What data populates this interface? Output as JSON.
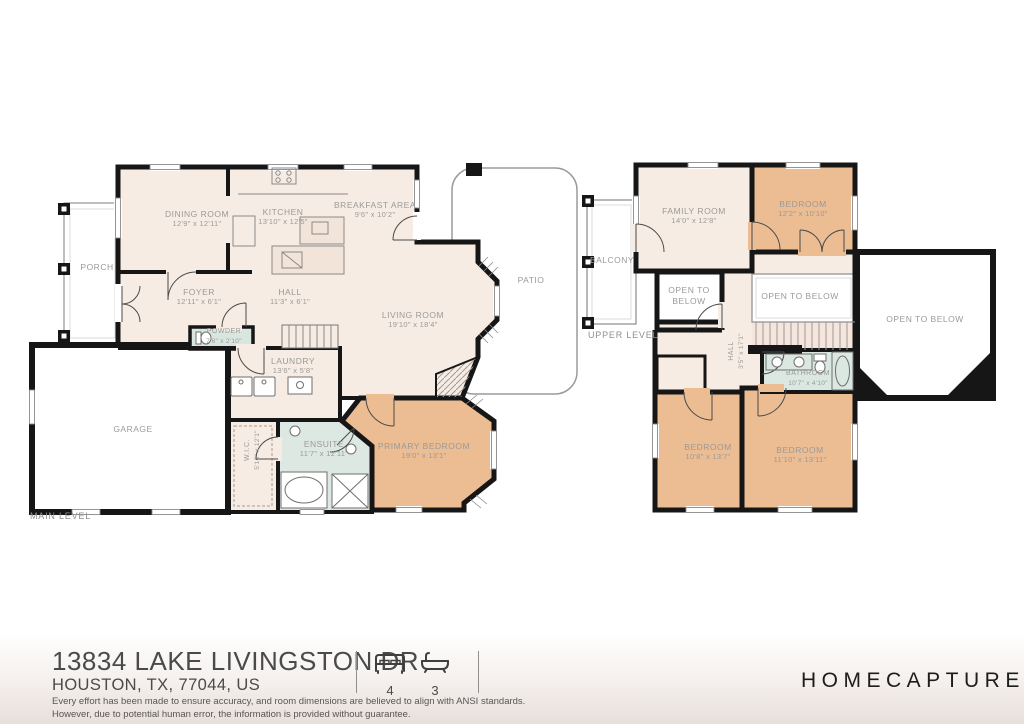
{
  "colors": {
    "wall": "#161616",
    "room_fill": "#f7ece3",
    "bedroom_fill": "#ecbc92",
    "bath_fill": "#dbe7e1",
    "label_text": "#9a9a9a",
    "brand_text": "#1d1d1d"
  },
  "main_level": {
    "label": "MAIN LEVEL",
    "rooms": {
      "dining": {
        "name": "DINING ROOM",
        "dims": "12'9\" x 12'11\""
      },
      "kitchen": {
        "name": "KITCHEN",
        "dims": "13'10\" x 12'5\""
      },
      "breakfast": {
        "name": "BREAKFAST AREA",
        "dims": "9'6\" x 10'2\""
      },
      "porch": {
        "name": "PORCH",
        "dims": ""
      },
      "foyer": {
        "name": "FOYER",
        "dims": "12'11\" x 6'1\""
      },
      "hall": {
        "name": "HALL",
        "dims": "11'3\" x 6'1\""
      },
      "living": {
        "name": "LIVING ROOM",
        "dims": "19'10\" x 18'4\""
      },
      "patio": {
        "name": "PATIO",
        "dims": ""
      },
      "powder": {
        "name": "POWDER",
        "dims": "7'6\" x 2'10\""
      },
      "laundry": {
        "name": "LAUNDRY",
        "dims": "13'6\" x 5'8\""
      },
      "garage": {
        "name": "GARAGE",
        "dims": ""
      },
      "wic": {
        "name": "W.I.C.",
        "dims": "5'10\" x 12'1\""
      },
      "ensuite": {
        "name": "ENSUITE",
        "dims": "11'7\" x 12'11\""
      },
      "primary": {
        "name": "PRIMARY BEDROOM",
        "dims": "19'0\" x 13'1\""
      }
    }
  },
  "upper_level": {
    "label": "UPPER LEVEL",
    "rooms": {
      "family": {
        "name": "FAMILY ROOM",
        "dims": "14'0\" x 12'8\""
      },
      "bedroom_a": {
        "name": "BEDROOM",
        "dims": "12'2\" x 10'10\""
      },
      "balcony": {
        "name": "BALCONY",
        "dims": ""
      },
      "open_small": {
        "name": "OPEN TO BELOW",
        "dims": ""
      },
      "open_mid": {
        "name": "OPEN TO BELOW",
        "dims": ""
      },
      "open_large": {
        "name": "OPEN TO BELOW",
        "dims": ""
      },
      "hall": {
        "name": "HALL",
        "dims": "3'5\" x 17'1\""
      },
      "bathroom": {
        "name": "BATHROOM",
        "dims": "10'7\" x 4'10\""
      },
      "bedroom_b": {
        "name": "BEDROOM",
        "dims": "10'8\" x 13'7\""
      },
      "bedroom_c": {
        "name": "BEDROOM",
        "dims": "11'10\" x 13'11\""
      }
    }
  },
  "footer": {
    "address_line1": "13834 LAKE LIVINGSTON DR",
    "address_line2": "HOUSTON, TX, 77044, US",
    "beds": "4",
    "baths": "3",
    "bed_icon": "bed-icon",
    "bath_icon": "bath-icon",
    "brand": "HOMECAPTURE",
    "disclaimer_line1": "Every effort has been made to ensure accuracy, and room dimensions are believed to align with ANSI standards.",
    "disclaimer_line2": "However, due to potential human error, the information is provided without guarantee."
  }
}
